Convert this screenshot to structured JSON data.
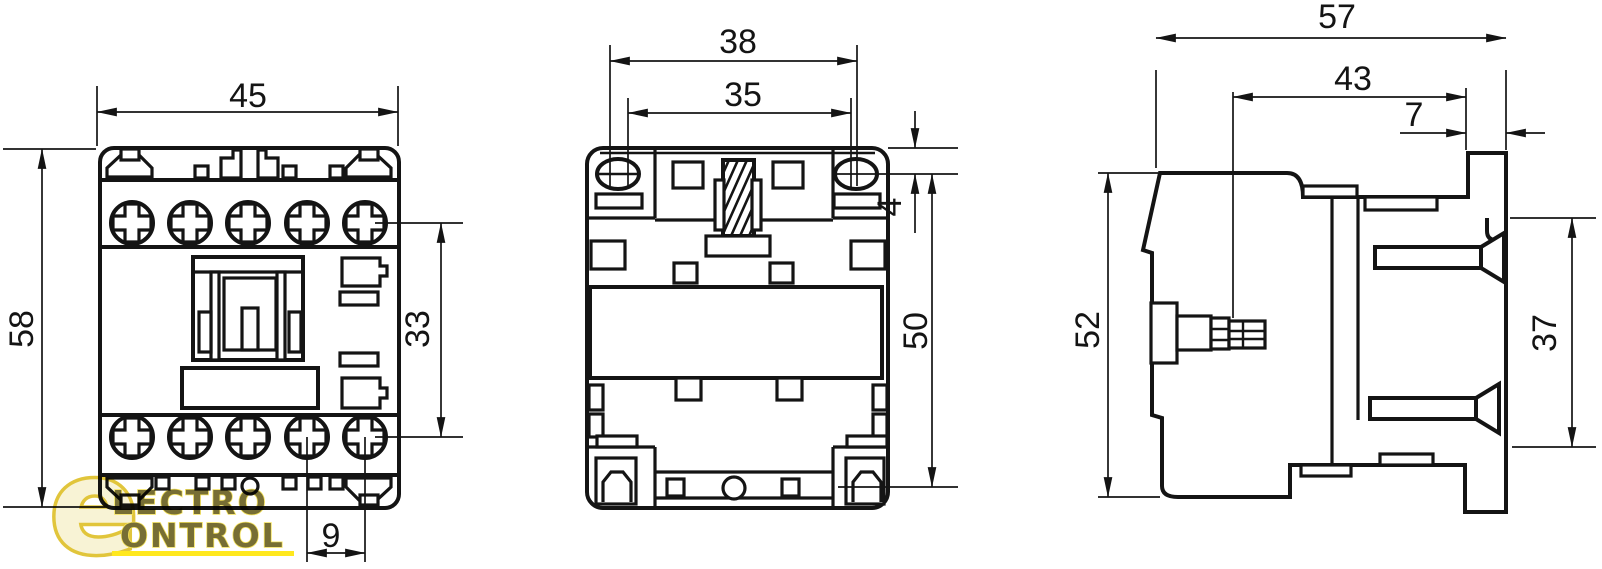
{
  "colors": {
    "line": "#141414",
    "background": "#ffffff",
    "watermark_fill": "#f8f2d2",
    "watermark_stroke": "#dfc02a",
    "watermark_text": "#6b6222",
    "watermark_text_outline": "#f4e04e",
    "watermark_underline": "#ffe60a"
  },
  "watermark": {
    "initial": "e",
    "line1": "LECTRO",
    "line2": "ONTROL"
  },
  "views": {
    "front": {
      "dims": {
        "width": "45",
        "height": "58",
        "contact_rows": "33",
        "pitch": "9"
      }
    },
    "bottom": {
      "dims": {
        "holes_outer": "38",
        "holes_inner": "35",
        "hole_offset": "4",
        "holes_vertical": "50"
      }
    },
    "side": {
      "dims": {
        "depth": "57",
        "body_depth": "43",
        "rail_lip": "7",
        "height": "52",
        "rail_clip": "37"
      }
    }
  }
}
